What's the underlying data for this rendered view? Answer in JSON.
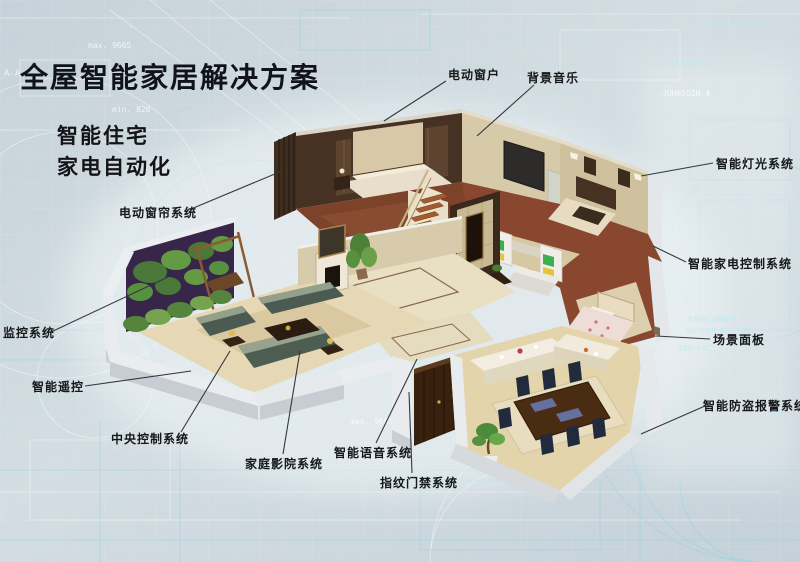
{
  "title": "全屋智能家居解决方案",
  "subtitle_line1": "智能住宅",
  "subtitle_line2": "家电自动化",
  "callouts": {
    "electric_window": "电动窗户",
    "background_music": "背景音乐",
    "smart_lighting": "智能灯光系统",
    "smart_appliance_control": "智能家电控制系统",
    "scene_panel": "场景面板",
    "smart_burglar_alarm": "智能防盗报警系统",
    "electric_curtain": "电动窗帘系统",
    "monitoring": "监控系统",
    "smart_remote": "智能遥控",
    "central_control": "中央控制系统",
    "home_theater": "家庭影院系统",
    "smart_voice": "智能语音系统",
    "fingerprint_access": "指纹门禁系统"
  },
  "blueprint_annotations": [
    "max. 9665",
    "min. 820",
    "DONAH 3AKOHN",
    "FASHAMMER",
    "JUH6SO2N 4",
    "FASKLAMMER",
    "GEFHSEP DIA BOHM",
    "200-FAC",
    "A-A"
  ],
  "colors": {
    "background": "#ccd7dd",
    "blueprint_line_cyan": "#8fd3e0",
    "blueprint_line_white": "#ffffff",
    "label_text": "#16181a",
    "leader_line": "#33383d",
    "house_wall_white": "#eaedef",
    "floor_tan": "#e3d4ab",
    "wood_floor": "#7d422a",
    "dark_wood": "#463122"
  }
}
